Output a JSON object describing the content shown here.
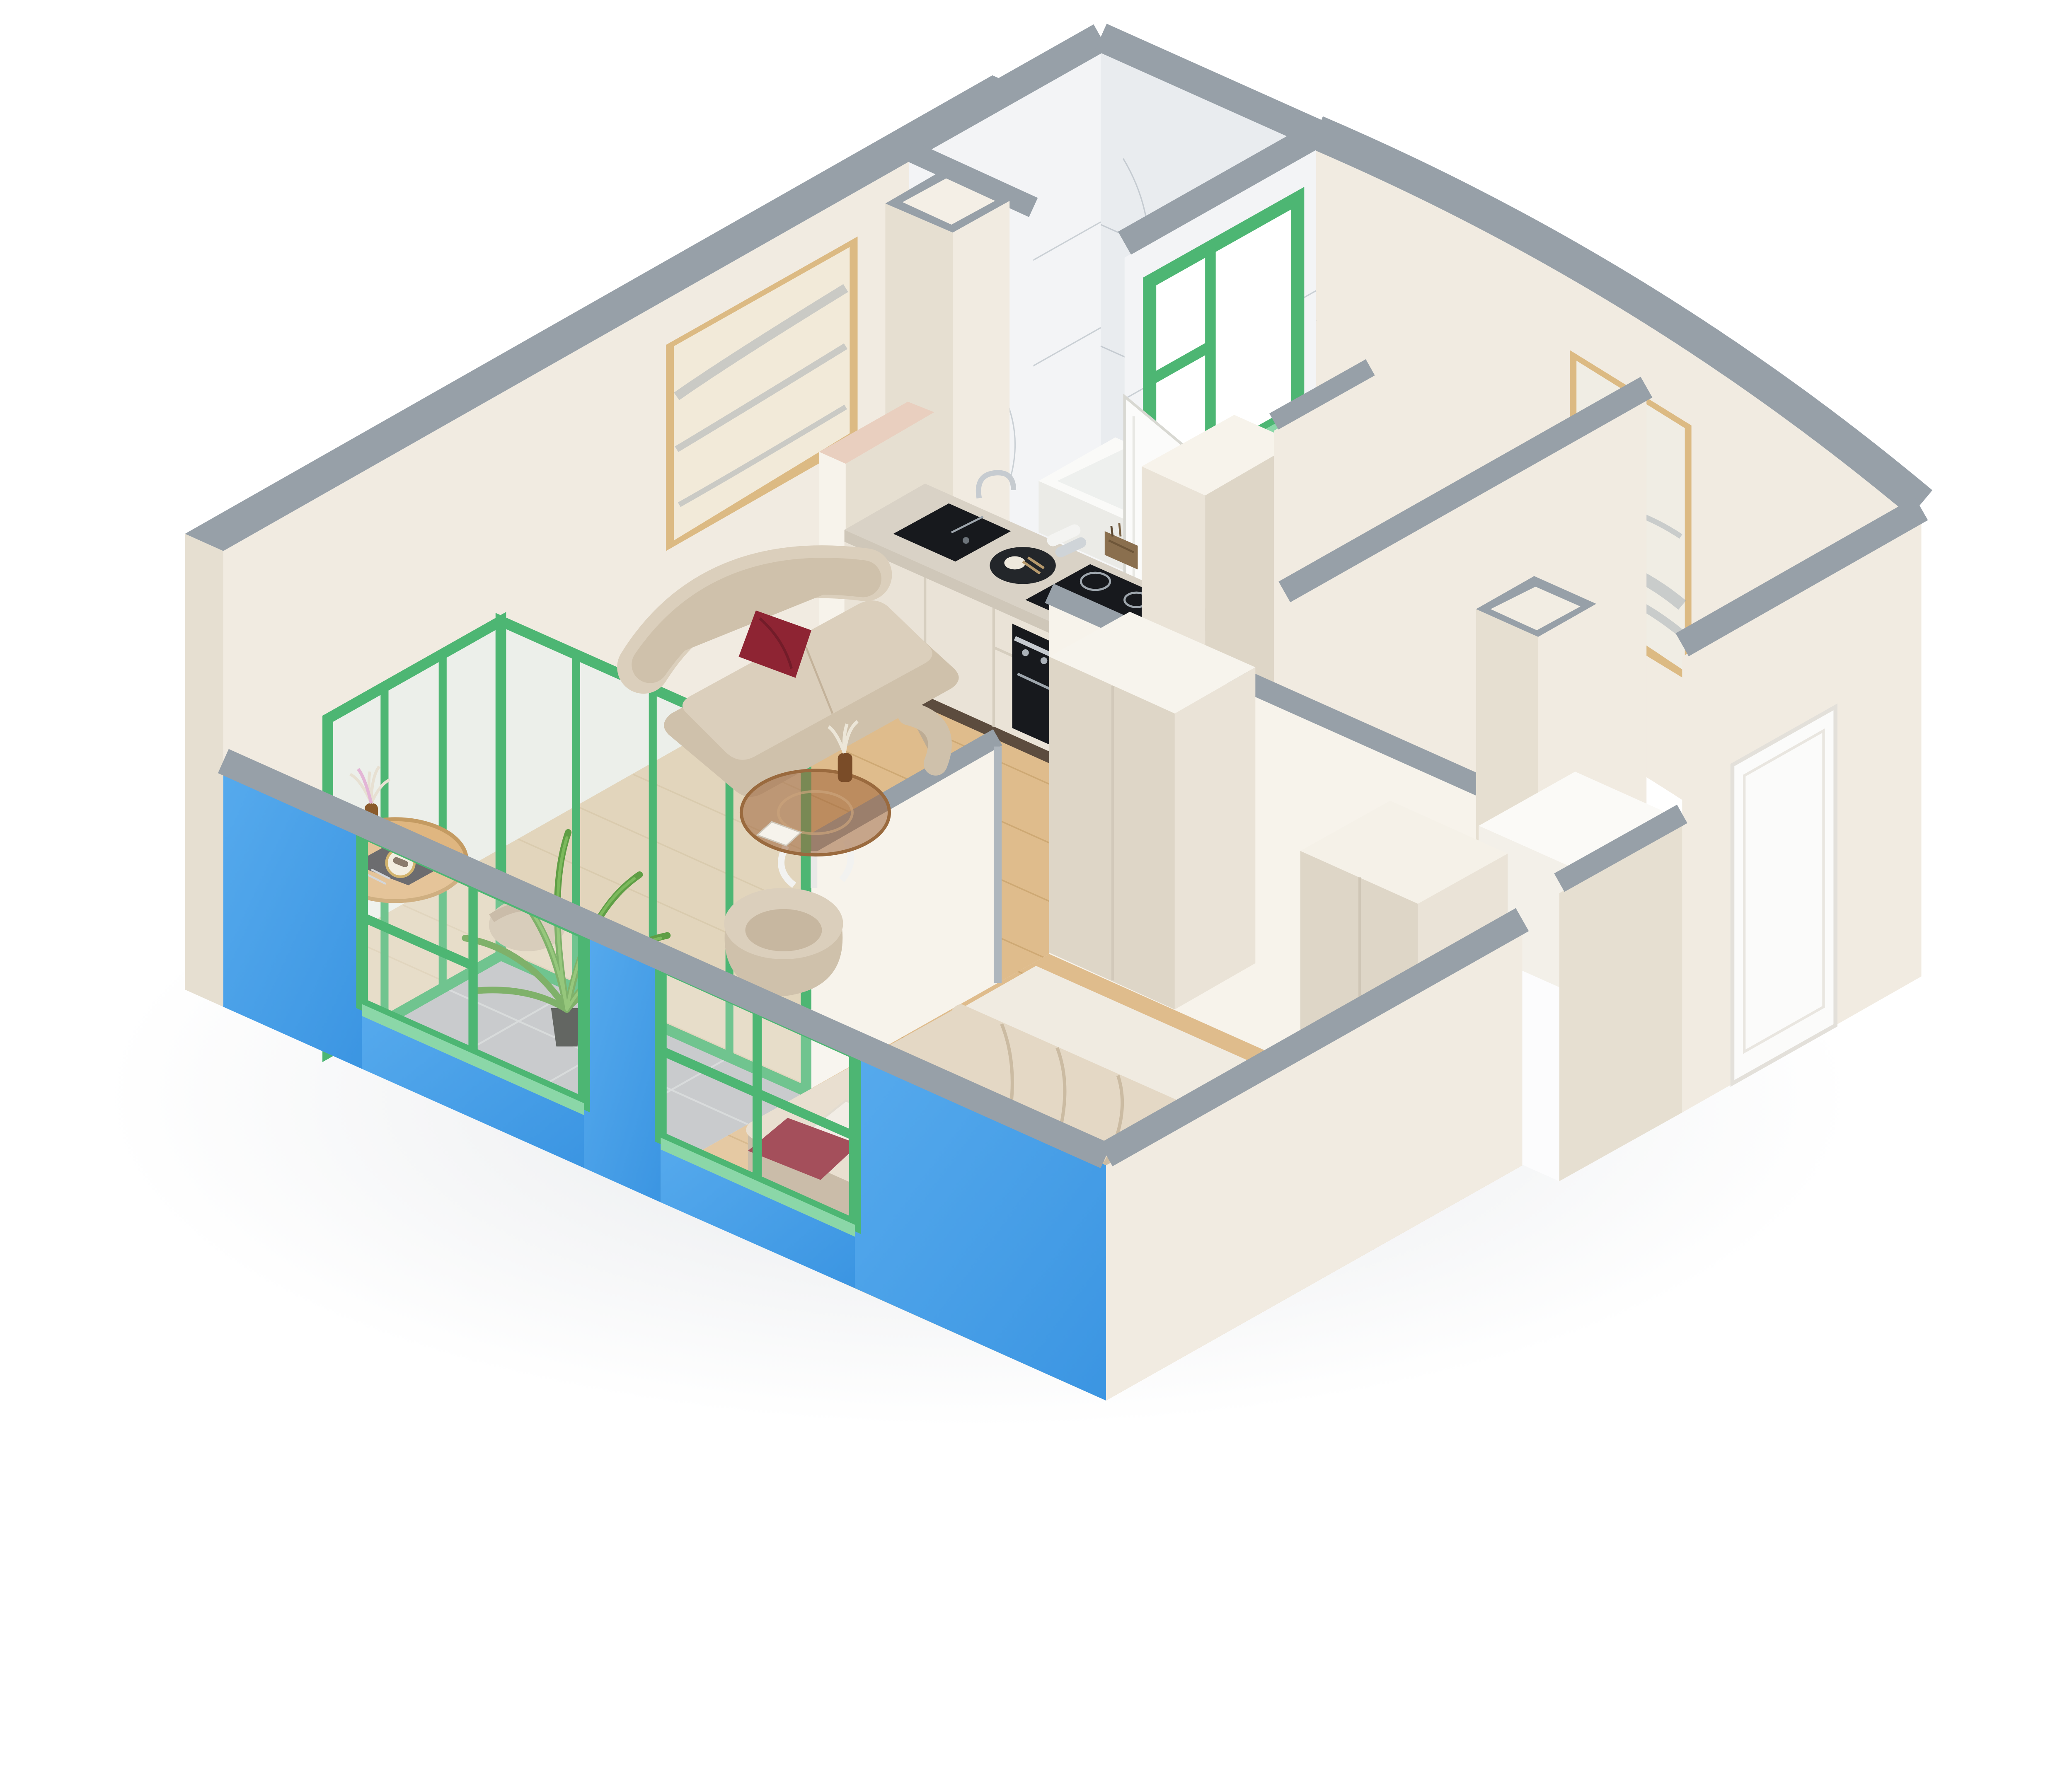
{
  "scene": {
    "type": "isometric-3d-floor-plan-render",
    "view": "cutaway dollhouse perspective, white background",
    "rooms": [
      {
        "name": "living-room",
        "floor": "light oak wood",
        "furniture": [
          "curved-beige-sofa",
          "dark-red-pillow",
          "round-glass-coffee-table",
          "vase-with-dried-flowers",
          "beige-armchair",
          "round-wood-dining-table",
          "two-beige-dining-chairs",
          "placemat-with-plate-and-cutlery",
          "framed-abstract-art"
        ]
      },
      {
        "name": "kitchen",
        "floor": "light oak wood",
        "furniture": [
          "cream-cabinet-run",
          "marble-countertop",
          "black-sink",
          "chrome-faucet",
          "round-serving-tray",
          "induction-cooktop",
          "built-in-oven",
          "pink-cabinet-block",
          "tall-cream-unit",
          "marble-backsplash"
        ]
      },
      {
        "name": "bathroom",
        "floor": "white marble tile",
        "furniture": [
          "white-bathtub",
          "rolled-towels",
          "wicker-basket",
          "green-framed-interior-window",
          "white-door-open"
        ]
      },
      {
        "name": "hallway",
        "floor": "light oak wood",
        "furniture": [
          "white-wardrobe-cabinet",
          "white-counter-block",
          "duct-shaft",
          "framed-gold-abstract-art"
        ]
      },
      {
        "name": "bedroom",
        "floor": "light oak wood",
        "furniture": [
          "double-bed-beige-duvet",
          "white-pillow",
          "dark-red-pillow",
          "tall-cream-wardrobe"
        ]
      },
      {
        "name": "balcony",
        "floor": "gray stone tile",
        "furniture": [
          "potted-palm-plant",
          "green-framed-glazing"
        ]
      },
      {
        "name": "entrance",
        "furniture": [
          "white-entrance-door"
        ]
      }
    ],
    "exterior": [
      "bright-blue-front-wall",
      "green-window-frames",
      "gray-wall-tops",
      "cream-walls"
    ]
  },
  "colors": {
    "bg": "#ffffff",
    "grayTop": "#97a0a8",
    "grayTopDark": "#8a939c",
    "wallCream": "#f1ebe1",
    "wallCreamLight": "#f7f3eb",
    "wallCreamDark": "#e6dfd1",
    "wallCreamDarker": "#dcd4c4",
    "blueWall": "#419de8",
    "blueWallLight": "#5cacee",
    "green": "#4db673",
    "greenLight": "#8bd7a8",
    "greenDark": "#3da05f",
    "wood": "#dfbc8c",
    "woodDark": "#c19a62",
    "woodLight": "#ecd2a9",
    "tile": "#bcbfc1",
    "tileLine": "#d2d5d6",
    "marble": "#f3f4f6",
    "marbleDark": "#e9ecef",
    "marbleVein": "#9aa4ad",
    "counterMarble": "#d9d2c6",
    "cabinet": "#eae3d7",
    "cabinetDark": "#ded6c7",
    "cabinetToe": "#5c4c3e",
    "appliance": "#17191d",
    "applianceLine": "#9ea6ad",
    "steel": "#c6cbd0",
    "pinkCab": "#e9cfbf",
    "sofa": "#cfc1ab",
    "sofaLight": "#dbcfbc",
    "sofaDark": "#bdac94",
    "redPillow": "#8e2433",
    "redPillowDark": "#731c29",
    "duvet": "#e4d8c5",
    "duvetLine": "#cbbba2",
    "mattress": "#f0ebe1",
    "bedSide": "#d2c3ac",
    "whitePillow": "#efe9e0",
    "artFrame": "#dcba83",
    "glass": "rgba(230,243,247,0.45)",
    "windowGlass": "rgba(255,255,255,0.2)",
    "palm": "#5f9e45",
    "palmLight": "#7cb95c",
    "pot": "#3c403b",
    "doorWhite": "#fbfbfa",
    "whiteFloor": "#fcfcfd",
    "tableWood": "#dfb680",
    "placemat": "#48484c",
    "plate": "#f1ead9",
    "plateRim": "#c8a24a",
    "vase": "#8a5a2b",
    "dried": "#e7e0d2",
    "driedPink": "#e3b5d6",
    "bronze": "rgba(158,100,58,0.55)",
    "bronzeRim": "#9a6a3e",
    "shadow": "rgba(170,178,188,0.22)"
  }
}
